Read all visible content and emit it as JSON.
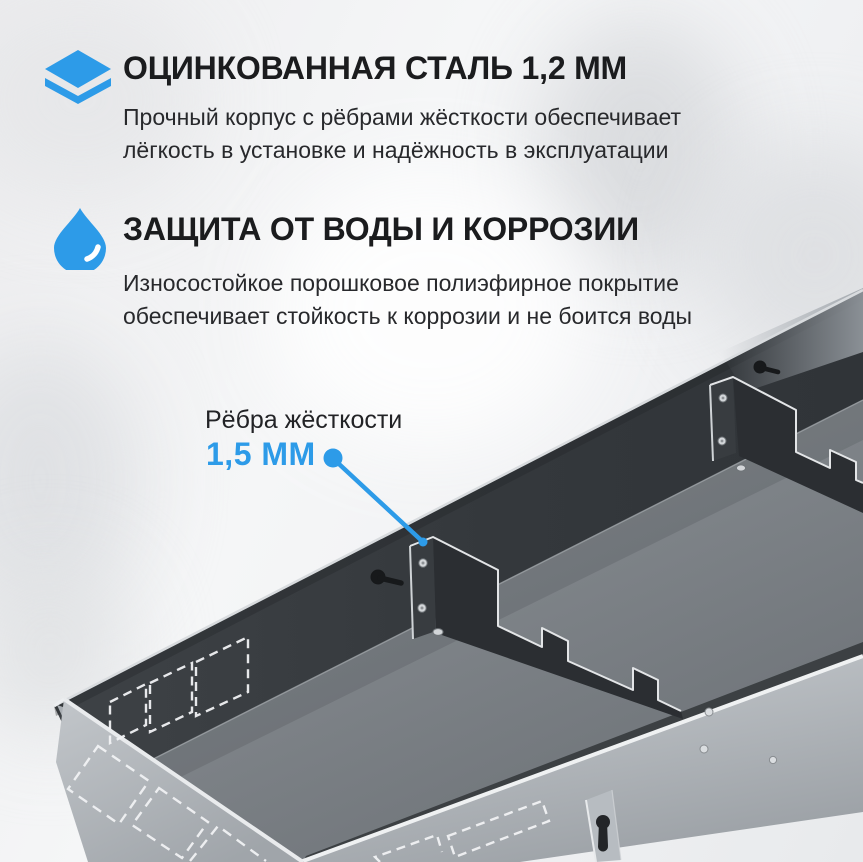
{
  "colors": {
    "accent_blue": "#2D9BE8",
    "title_text": "#1B1C1E",
    "body_text": "#28292C",
    "tray_wall_dark": "#34383C",
    "tray_floor_gray": "#7D8287",
    "tray_exterior_light": "#B3B8BD"
  },
  "features": [
    {
      "icon": "layers-icon",
      "title": "ОЦИНКОВАННАЯ СТАЛЬ 1,2 ММ",
      "line1": "Прочный корпус с рёбрами жёсткости обеспечивает",
      "line2": "лёгкость в установке и надёжность в эксплуатации"
    },
    {
      "icon": "water-drop-icon",
      "title": "ЗАЩИТА ОТ ВОДЫ И КОРРОЗИИ",
      "line1": "Износостойкое порошковое полиэфирное покрытие",
      "line2": "обеспечивает стойкость к коррозии и не боится воды"
    }
  ],
  "callout": {
    "label": "Рёбра жёсткости",
    "value": "1,5 ММ"
  }
}
